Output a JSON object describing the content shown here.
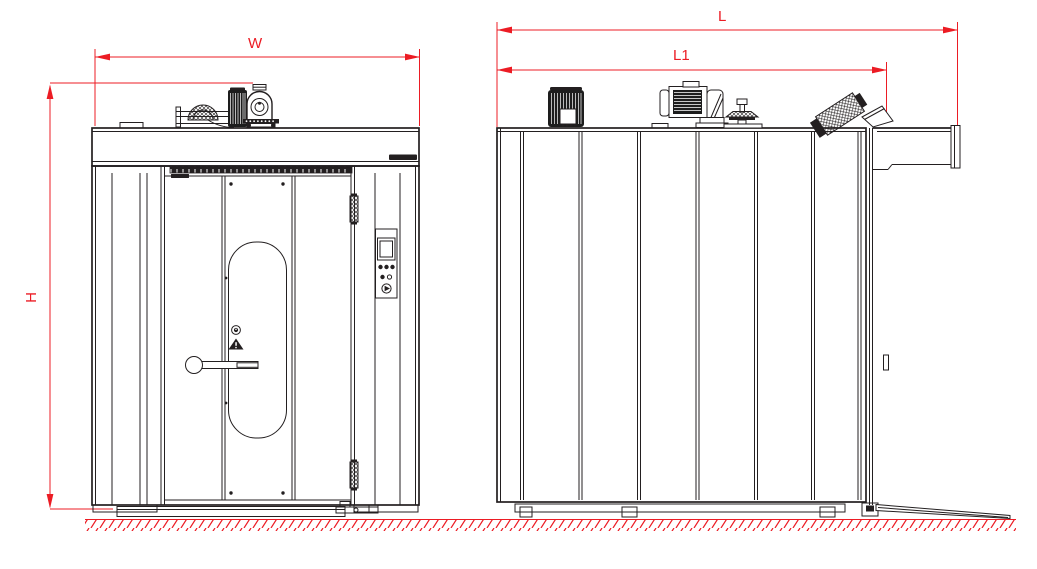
{
  "drawing": {
    "dimension_labels": {
      "width": "W",
      "height": "H",
      "length": "L",
      "length_partial": "L1"
    },
    "colors": {
      "dimension_red": "#ec1c24",
      "line_dark": "#231f20",
      "background": "#ffffff"
    },
    "icons": [
      "hot-surface-icon",
      "caution-triangle-icon",
      "door-handle",
      "control-display"
    ]
  }
}
